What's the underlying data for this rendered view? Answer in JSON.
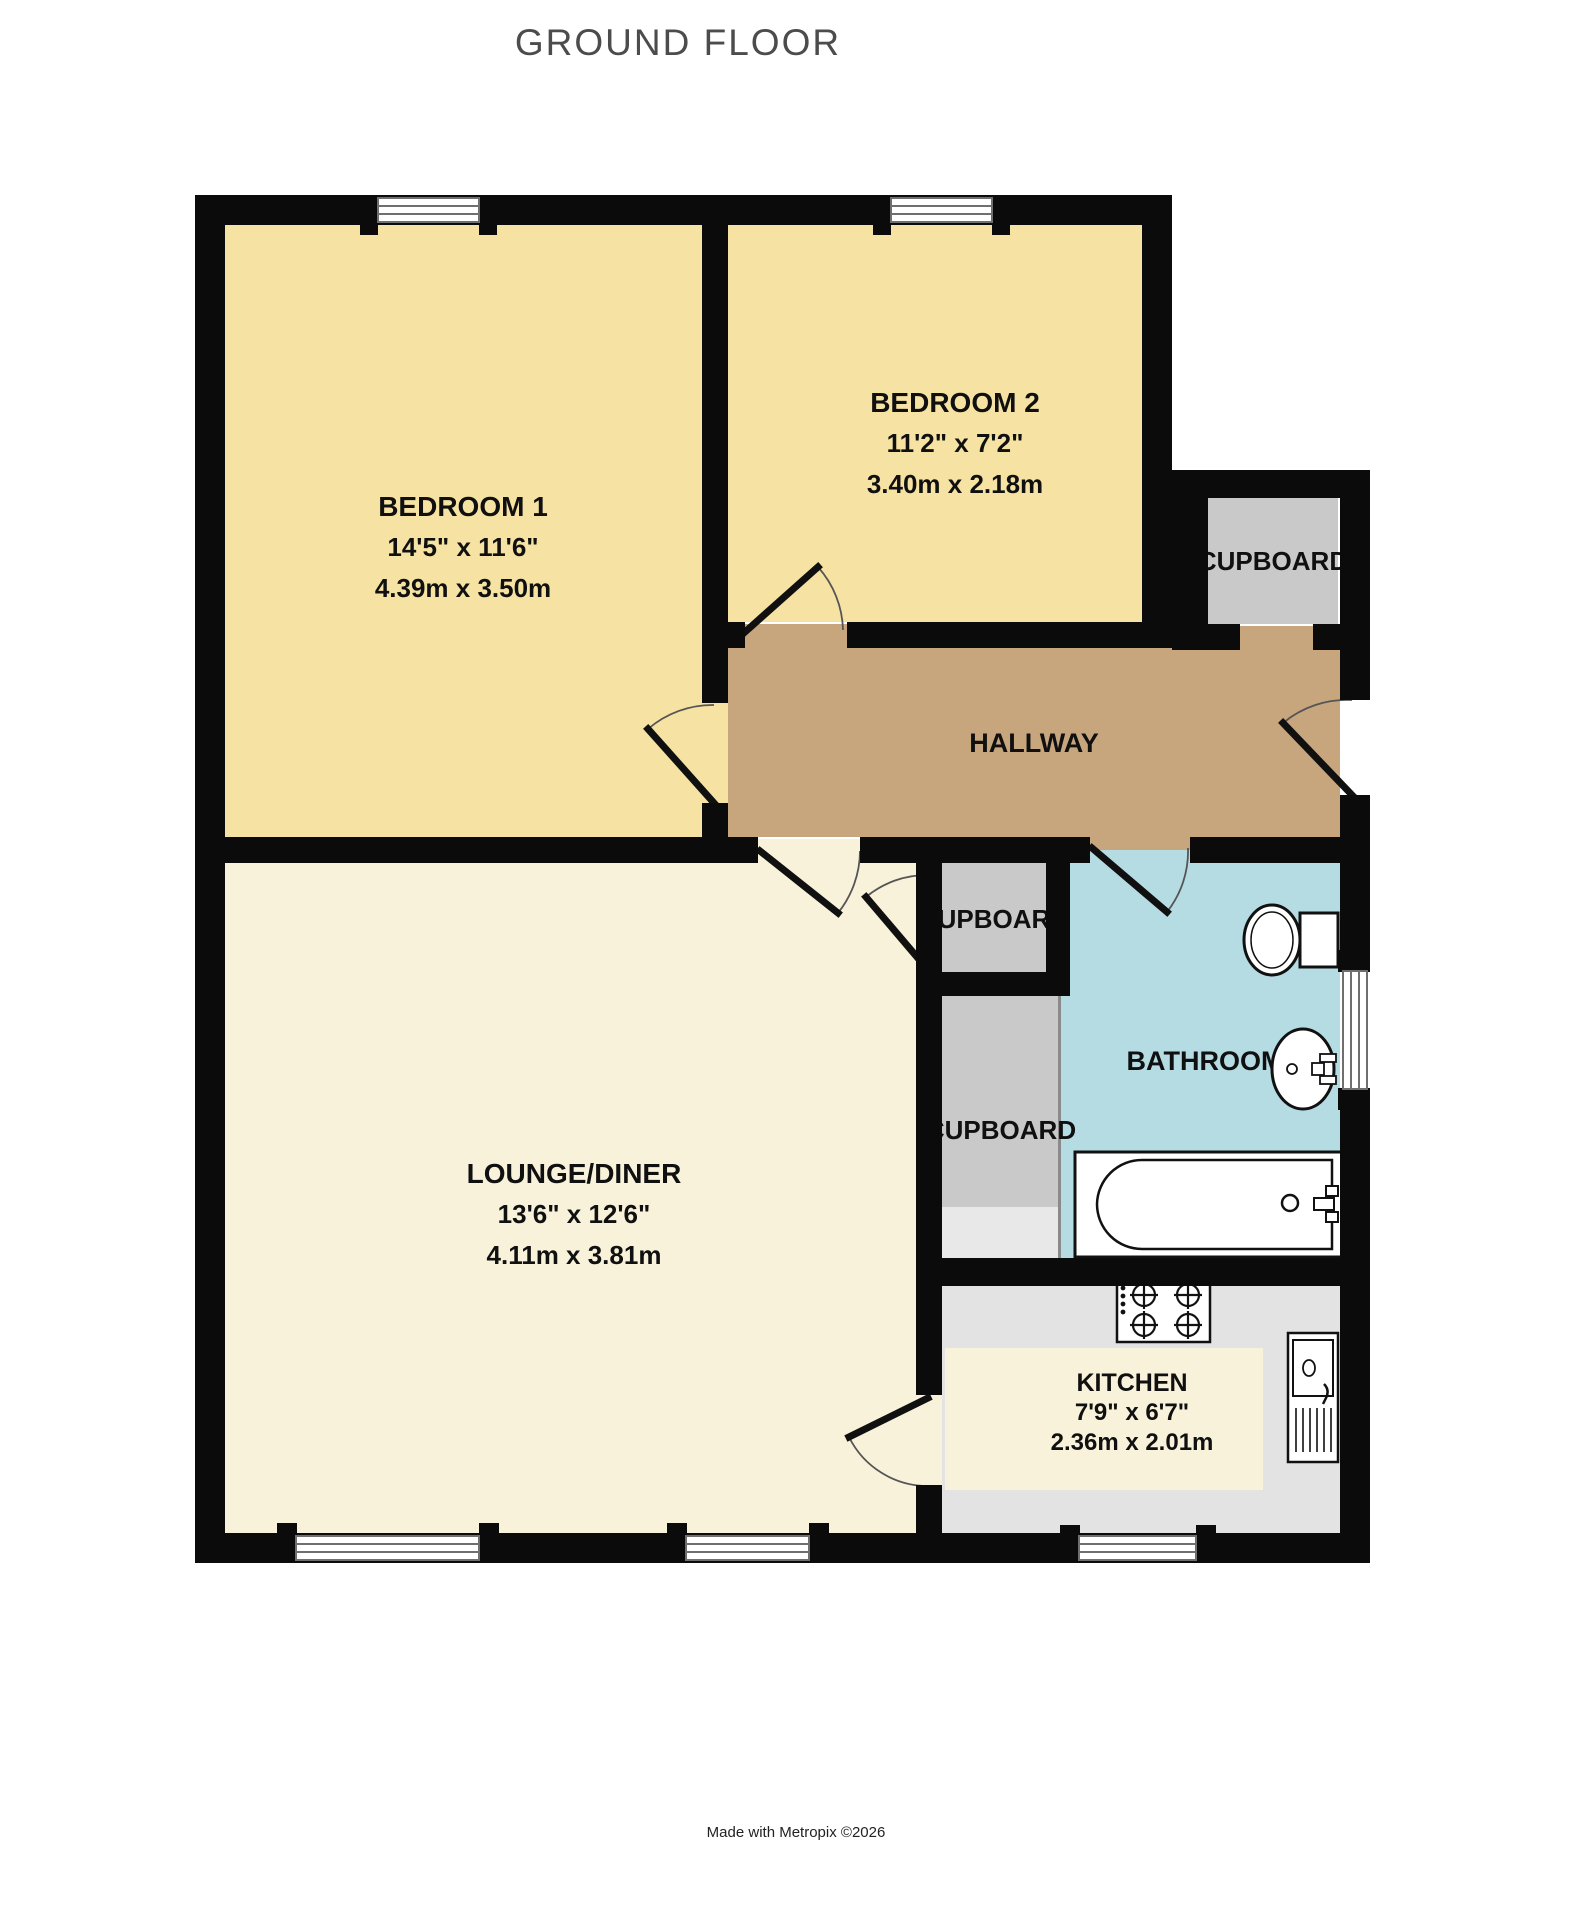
{
  "title": "GROUND FLOOR",
  "footer": "Made with Metropix ©2026",
  "colors": {
    "wall": "#0B0B0B",
    "bedroom_fill": "#F6E3A3",
    "lounge_fill": "#F9F2DB",
    "hallway_fill": "#C7A67E",
    "bathroom_fill": "#B5DBE3",
    "cupboard_fill": "#C9C9C9",
    "kitchen_fill": "#E3E3E3",
    "title_color": "#4C4C4C"
  },
  "rooms": {
    "bedroom1": {
      "name": "BEDROOM 1",
      "imperial": "14'5\" x 11'6\"",
      "metric": "4.39m x 3.50m"
    },
    "bedroom2": {
      "name": "BEDROOM 2",
      "imperial": "11'2\" x 7'2\"",
      "metric": "3.40m x 2.18m"
    },
    "lounge": {
      "name": "LOUNGE/DINER",
      "imperial": "13'6\" x 12'6\"",
      "metric": "4.11m x 3.81m"
    },
    "kitchen": {
      "name": "KITCHEN",
      "imperial": "7'9\" x 6'7\"",
      "metric": "2.36m x 2.01m"
    },
    "hallway": {
      "name": "HALLWAY"
    },
    "bathroom": {
      "name": "BATHROOM"
    },
    "cupboard_top": {
      "name": "CUPBOARD"
    },
    "cupboard_middle": {
      "name": "CUPBOARD"
    },
    "cupboard_lower": {
      "name": "CUPBOARD"
    }
  },
  "fixtures": [
    "toilet-icon",
    "bathroom-sink-icon",
    "bath-icon",
    "hob-icon",
    "kitchen-sink-icon"
  ]
}
